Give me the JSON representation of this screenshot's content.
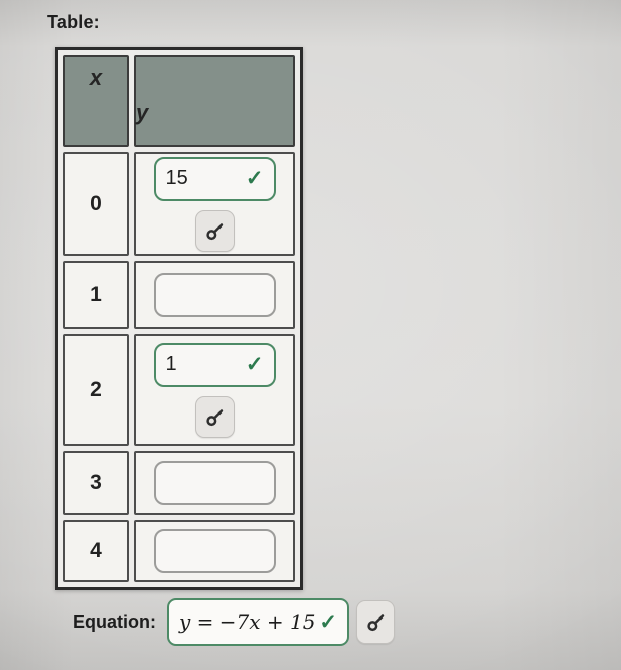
{
  "page": {
    "title": "Table:"
  },
  "table": {
    "headers": {
      "x": "x",
      "y": "y"
    },
    "rows": [
      {
        "x": "0",
        "y_value": "15",
        "answered": true
      },
      {
        "x": "1",
        "y_value": "",
        "answered": false
      },
      {
        "x": "2",
        "y_value": "1",
        "answered": true
      },
      {
        "x": "3",
        "y_value": "",
        "answered": false
      },
      {
        "x": "4",
        "y_value": "",
        "answered": false
      }
    ]
  },
  "equation": {
    "label": "Equation:",
    "value": "y = −7x + 15",
    "answered": true
  },
  "icons": {
    "check": "✓",
    "key": "key-icon"
  },
  "colors": {
    "accent_green": "#2d7a4e",
    "header_bg": "#84908a",
    "page_bg": "#d8d7d5"
  }
}
